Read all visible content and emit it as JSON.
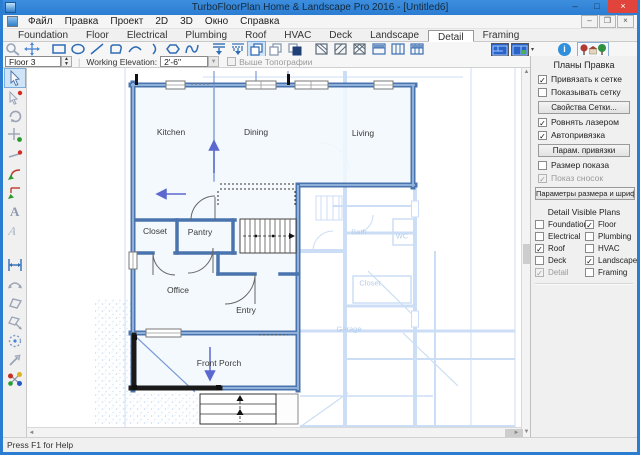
{
  "window": {
    "title": "TurboFloorPlan Home & Landscape Pro 2016 - [Untitled6]",
    "status": "Press F1 for Help"
  },
  "menu": {
    "items": [
      "Файл",
      "Правка",
      "Проект",
      "2D",
      "3D",
      "Окно",
      "Справка"
    ]
  },
  "tabs": {
    "items": [
      {
        "label": "Foundation"
      },
      {
        "label": "Floor"
      },
      {
        "label": "Electrical"
      },
      {
        "label": "Plumbing"
      },
      {
        "label": "Roof"
      },
      {
        "label": "HVAC"
      },
      {
        "label": "Deck"
      },
      {
        "label": "Landscape"
      },
      {
        "label": "Detail",
        "active": true
      },
      {
        "label": "Framing"
      }
    ]
  },
  "toolbar": {
    "icons": [
      "zoom-tool",
      "pan-tool",
      "rectangle-tool",
      "ellipse-tool",
      "line-tool",
      "closed-curve-tool",
      "arc-tool",
      "curve-arc-tool",
      "polygon-tool",
      "spline-tool",
      "dimension-tool",
      "dimension-auto-tool",
      "duplicate-tool",
      "copy-tool",
      "paste-tool",
      "hatch-diagonal-tool",
      "hatch-lines-tool",
      "hatch-cross-tool",
      "split-horizontal-tool",
      "split-vertical-tool",
      "grid-table-tool",
      "plan-thumbnail-1",
      "plan-thumbnail-2",
      "info-button",
      "site-view-button"
    ]
  },
  "floor_bar": {
    "floor": "Floor 3",
    "elevation_label": "Working Elevation:",
    "elevation_value": "2'-6\"",
    "topo_label": "Выше Топографии",
    "topo": {
      "checked": false,
      "disabled": true
    }
  },
  "palette": {
    "icons": [
      "select",
      "select-node",
      "rotate",
      "snap-point",
      "line-point",
      "fillet",
      "chamfer",
      "text",
      "text-italic",
      "dimension",
      "curved-dimension",
      "polygon",
      "polygon-edit",
      "spray",
      "pointer-ne",
      "connection-hub"
    ]
  },
  "right_panel": {
    "title": "Планы Правка",
    "checks": [
      {
        "label": "Привязать к сетке",
        "checked": true
      },
      {
        "label": "Показывать сетку",
        "checked": false
      },
      {
        "label": "Ровнять лазером",
        "checked": true
      },
      {
        "label": "Автопривязка",
        "checked": true
      },
      {
        "label": "Размер показа",
        "checked": false
      },
      {
        "label": "Показ сносок",
        "checked": true,
        "disabled": true
      }
    ],
    "buttons": {
      "grid": "Свойства Сетки...",
      "snap": "Парам. привязки",
      "font": "Параметры размера и шрифта..."
    },
    "visible_plans": {
      "title": "Detail Visible Plans",
      "items": [
        {
          "label": "Foundation",
          "checked": false
        },
        {
          "label": "Floor",
          "checked": true
        },
        {
          "label": "Electrical",
          "checked": false
        },
        {
          "label": "Plumbing",
          "checked": false
        },
        {
          "label": "Roof",
          "checked": true
        },
        {
          "label": "HVAC",
          "checked": false
        },
        {
          "label": "Deck",
          "checked": false
        },
        {
          "label": "Landscape",
          "checked": true
        },
        {
          "label": "Detail",
          "checked": true,
          "disabled": true
        },
        {
          "label": "Framing",
          "checked": false
        }
      ]
    }
  },
  "canvas": {
    "rooms": [
      {
        "label": "Kitchen"
      },
      {
        "label": "Dining"
      },
      {
        "label": "Living"
      },
      {
        "label": "Closet"
      },
      {
        "label": "Pantry"
      },
      {
        "label": "Office"
      },
      {
        "label": "Entry"
      },
      {
        "label": "Front Porch"
      }
    ],
    "faint_labels": [
      {
        "label": "Bath"
      },
      {
        "label": "WC"
      },
      {
        "label": "Closet"
      },
      {
        "label": "Garage"
      }
    ]
  },
  "colors": {
    "titlebar": "#2b7dd2",
    "wall": "#4a74ad",
    "wall_light": "#8fb0d9",
    "underlay": "#c9dcf4",
    "selection": "#1a1a1a",
    "arrow": "#5b68cf",
    "panel": "#f0f0f0",
    "canvas": "#ffffff",
    "accent": "#2e6db5"
  }
}
